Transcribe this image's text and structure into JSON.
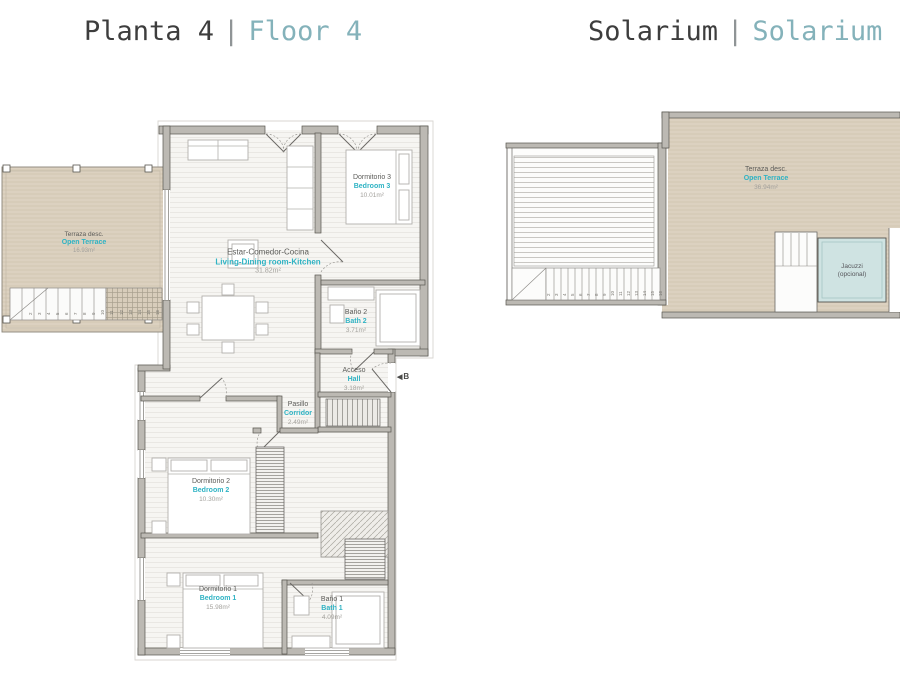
{
  "titles": {
    "left": {
      "primary": "Planta 4",
      "separator": "|",
      "secondary": "Floor 4"
    },
    "right": {
      "primary": "Solarium",
      "separator": "|",
      "secondary": "Solarium"
    }
  },
  "floor4": {
    "rooms": {
      "terrace": {
        "name_es": "Terraza desc.",
        "name_en": "Open Terrace",
        "area": "16.93m²"
      },
      "living": {
        "name_es": "Estar-Comedor-Cocina",
        "name_en": "Living-Dining room-Kitchen",
        "area": "31.82m²"
      },
      "bedroom3": {
        "name_es": "Dormitorio 3",
        "name_en": "Bedroom 3",
        "area": "10.01m²"
      },
      "bath2": {
        "name_es": "Baño 2",
        "name_en": "Bath 2",
        "area": "3.71m²"
      },
      "hall": {
        "name_es": "Acceso",
        "name_en": "Hall",
        "area": "3.18m²"
      },
      "corridor": {
        "name_es": "Pasillo",
        "name_en": "Corridor",
        "area": "2.49m²"
      },
      "bedroom2": {
        "name_es": "Dormitorio 2",
        "name_en": "Bedroom 2",
        "area": "10.30m²"
      },
      "bedroom1": {
        "name_es": "Dormitorio 1",
        "name_en": "Bedroom 1",
        "area": "15.98m²"
      },
      "bath1": {
        "name_es": "Baño 1",
        "name_en": "Bath 1",
        "area": "4.09m²"
      }
    },
    "entrance_marker": "B"
  },
  "solarium": {
    "rooms": {
      "terrace": {
        "name_es": "Terraza desc.",
        "name_en": "Open Terrace",
        "area": "36.94m²"
      },
      "jacuzzi": {
        "line1": "Jacuzzi",
        "line2": "(opcional)"
      }
    }
  },
  "stairs": {
    "numbers": [
      "2",
      "3",
      "4",
      "5",
      "6",
      "7",
      "8",
      "9",
      "10",
      "11",
      "12",
      "13",
      "14",
      "15",
      "16"
    ]
  },
  "colors": {
    "accent": "#2fb3c4",
    "title_accent": "#84b2ba",
    "terrace_fill": "#dcd1c0",
    "wall_fill": "#bcb9b3",
    "wall_edge": "#57554f",
    "jacuzzi_fill": "#cfe3e2"
  }
}
